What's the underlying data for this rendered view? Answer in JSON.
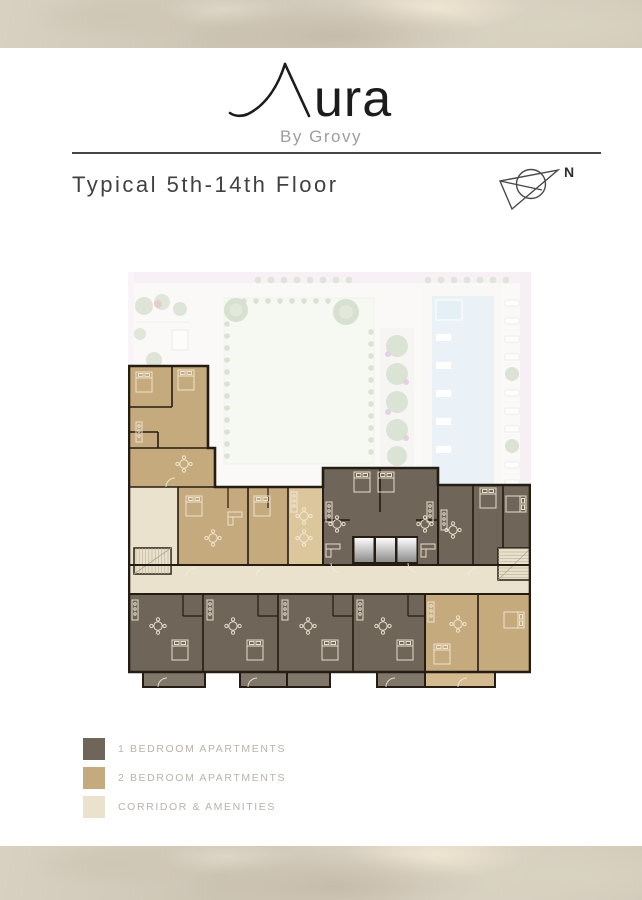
{
  "logo": {
    "name": "Aura",
    "name_rest": "ura",
    "tagline": "By Grovy"
  },
  "header": {
    "title": "Typical 5th-14th Floor"
  },
  "compass": {
    "label": "N"
  },
  "legend": {
    "items": [
      {
        "label": "1 BEDROOM APARTMENTS",
        "color": "#6f6558"
      },
      {
        "label": "2 BEDROOM APARTMENTS",
        "color": "#c4aa7d"
      },
      {
        "label": "CORRIDOR & AMENITIES",
        "color": "#ebe2cd"
      }
    ]
  },
  "plan": {
    "wall_color": "#251d13",
    "kitchen_zone_color": "#dcc69c",
    "pool_color": "#d9e8f1",
    "landscape_color": "#bfcbb4"
  }
}
